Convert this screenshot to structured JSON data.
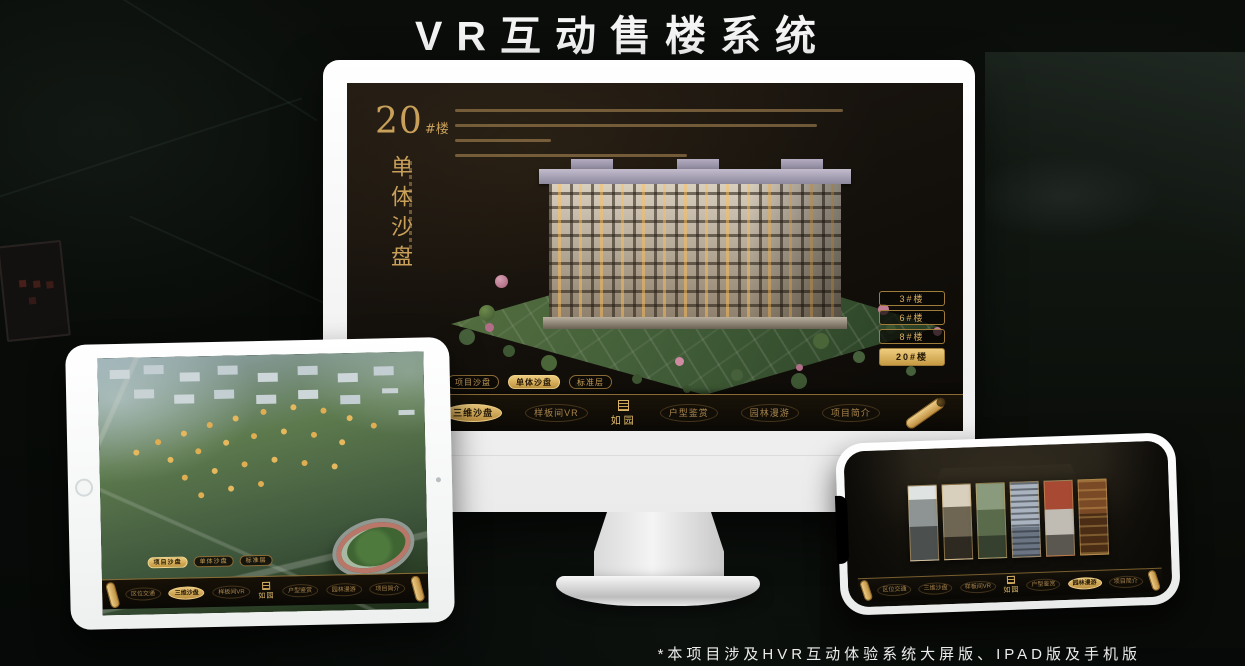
{
  "page": {
    "title": "VR互动售楼系统",
    "footnote": "*本项目涉及HVR互动体验系统大屏版、IPAD版及手机版"
  },
  "colors": {
    "gold": "#c9a05a",
    "gold_active": "#e9c678",
    "screen_background": "#15110c",
    "device_frame": "#ffffff"
  },
  "app": {
    "logo": "如园",
    "tabs": [
      "项目沙盘",
      "单体沙盘",
      "标准层"
    ],
    "menu_items": [
      "区位交通",
      "三维沙盘",
      "样板间VR",
      "户型鉴赏",
      "园林漫游",
      "项目简介"
    ]
  },
  "monitor": {
    "heading_number": "20",
    "heading_suffix": "#楼",
    "vertical_title": "单体沙盘",
    "building_buttons": [
      "3#楼",
      "6#楼",
      "8#楼",
      "20#楼"
    ],
    "active_building": "20#楼",
    "active_tab": "单体沙盘",
    "active_menu": "三维沙盘"
  },
  "tablet": {
    "active_tab": "项目沙盘",
    "active_menu": "三维沙盘"
  },
  "phone": {
    "active_menu": "园林漫游"
  }
}
